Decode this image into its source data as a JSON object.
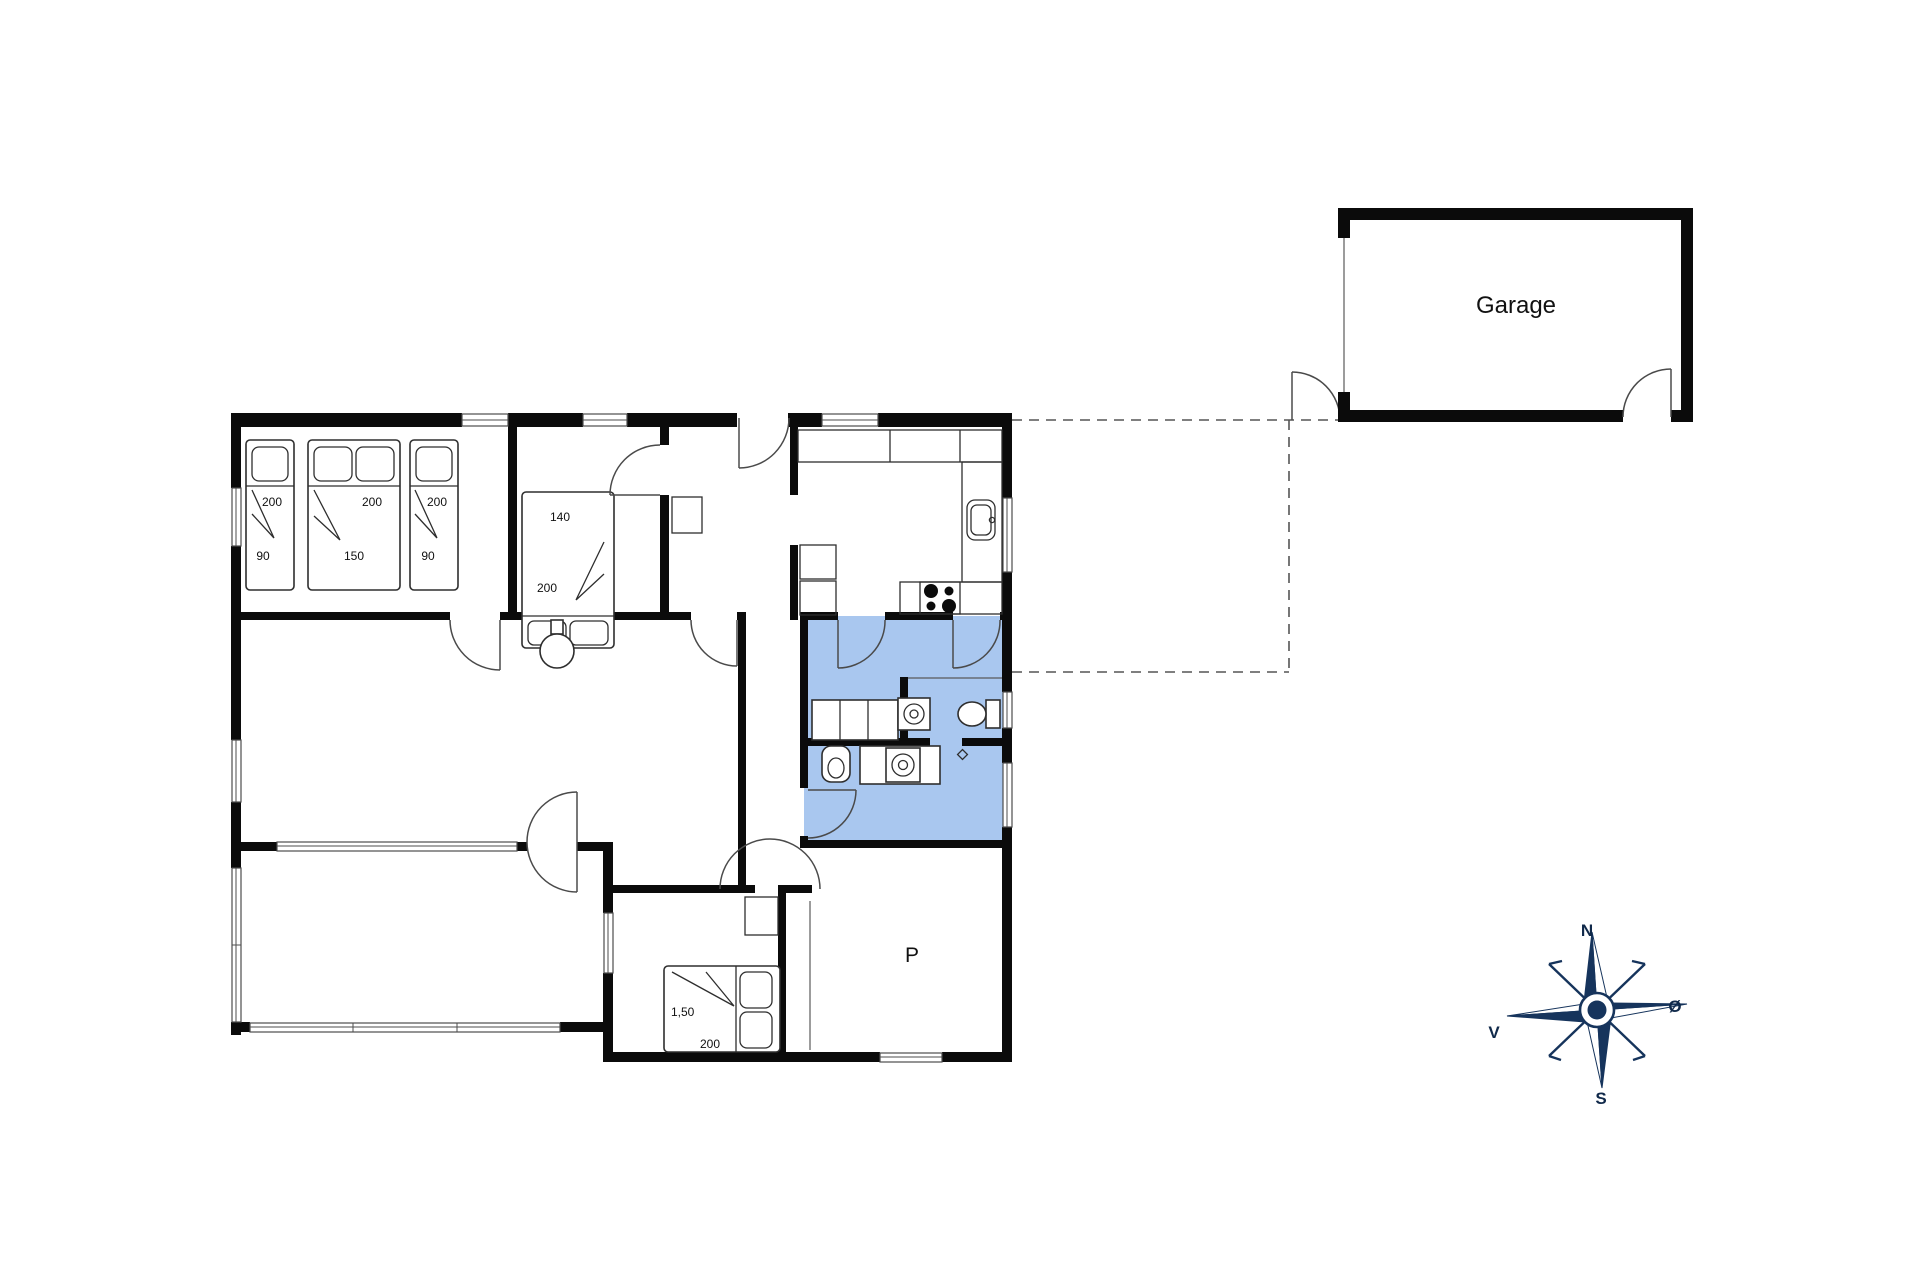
{
  "garage": {
    "label": "Garage"
  },
  "room_p": {
    "label": "P"
  },
  "beds": {
    "b1_length": "200",
    "b1_width": "90",
    "b2_length": "200",
    "b2_width": "150",
    "b3_length": "200",
    "b3_width": "90",
    "b4_width": "140",
    "b4_length": "200",
    "b5_width": "1,50",
    "b5_length": "200"
  },
  "compass": {
    "north": "N",
    "east": "Ø",
    "south": "S",
    "west": "V"
  },
  "colors": {
    "wall": "#0b0b0b",
    "bathroom_fill": "#a9c7ef",
    "compass_navy": "#16345c",
    "door_line": "#4a4a4a"
  }
}
